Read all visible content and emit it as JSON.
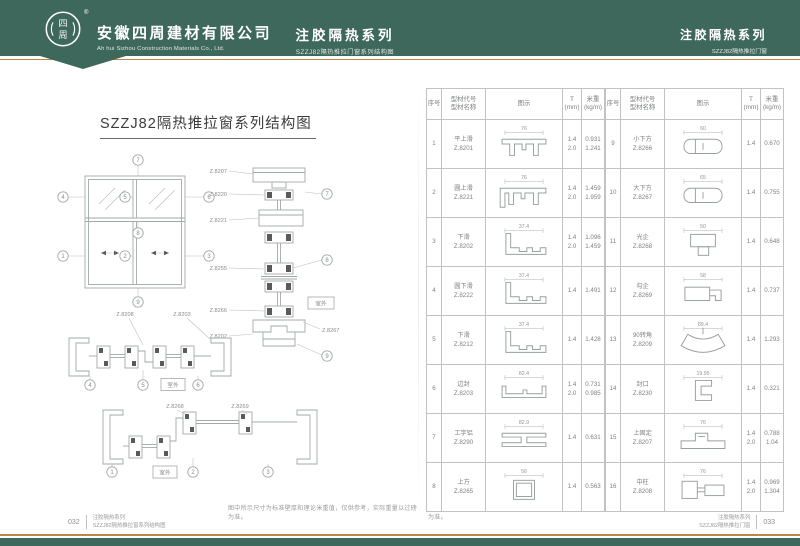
{
  "colors": {
    "header_green": "#3e685b",
    "accent_orange": "#c08448"
  },
  "header": {
    "logo_text": "四周",
    "registered_mark": "®",
    "company_name": "安徽四周建材有限公司",
    "company_name_en": "Ah hui Sizhou Construction Materials Co., Ltd.",
    "series_title": "注胶隔热系列",
    "series_subtitle": "SZZJ82隔热推拉门窗系列结构图",
    "series_title_right": "注胶隔热系列",
    "series_subtitle_right": "SZZJ82隔热推拉门窗"
  },
  "left_page": {
    "title": "SZZJ82隔热推拉窗系列结构图",
    "elevation_callouts": [
      "1",
      "2",
      "3",
      "4",
      "5",
      "6",
      "7",
      "8",
      "9"
    ],
    "vertical_labels": [
      "Z.8207",
      "Z.8220",
      "Z.8221",
      "Z.8255",
      "Z.8266",
      "Z.8202"
    ],
    "vertical_label_right": "Z.8267",
    "vertical_callouts": [
      "7",
      "8",
      "9"
    ],
    "h1_labels": [
      "Z.8208",
      "Z.8203"
    ],
    "h1_callouts": [
      "4",
      "5",
      "6"
    ],
    "h2_labels": [
      "Z.8268",
      "Z.8269"
    ],
    "h2_callouts": [
      "1",
      "2",
      "3"
    ],
    "outdoor_label": "室外",
    "note": "图中所示尺寸为标准壁厚和理论米重值，仅供参考，实际重量以过磅为准。"
  },
  "right_page": {
    "note": "图中所示尺寸为标准壁厚和理论米重值，仅供参考，实际重量以过磅为准。"
  },
  "tables": [
    {
      "headers": {
        "no": "序号",
        "name": "型材代号\n型材名称",
        "diagram": "图示",
        "t": "T\n(mm)",
        "weight": "米重\n(kg/m)"
      },
      "rows": [
        {
          "no": "1",
          "name": "平上滑",
          "code": "Z.8201",
          "t": "1.4\n2.0",
          "weight": "0.931\n1.241",
          "dim": "76",
          "shape": "tophat"
        },
        {
          "no": "2",
          "name": "圆上滑",
          "code": "Z.8221",
          "t": "1.4\n2.0",
          "weight": "1.459\n1.959",
          "dim": "76",
          "shape": "tophat2"
        },
        {
          "no": "3",
          "name": "下滑",
          "code": "Z.8202",
          "t": "1.4\n2.0",
          "weight": "1.096\n1.459",
          "dim": "37.4",
          "shape": "lrail"
        },
        {
          "no": "4",
          "name": "圆下滑",
          "code": "Z.8222",
          "t": "1.4",
          "weight": "1.491",
          "dim": "37.4",
          "shape": "lrail"
        },
        {
          "no": "5",
          "name": "下滑",
          "code": "Z.8212",
          "t": "1.4",
          "weight": "1.428",
          "dim": "37.4",
          "shape": "lrail"
        },
        {
          "no": "6",
          "name": "边封",
          "code": "Z.8203",
          "t": "1.4\n2.0",
          "weight": "0.731\n0.985",
          "dim": "82.4",
          "shape": "channel"
        },
        {
          "no": "7",
          "name": "工字铝",
          "code": "Z.8290",
          "t": "1.4",
          "weight": "0.631",
          "dim": "82.9",
          "shape": "ibeam"
        },
        {
          "no": "8",
          "name": "上方",
          "code": "Z.8265",
          "t": "1.4",
          "weight": "0.563",
          "dim": "56",
          "shape": "tube"
        }
      ]
    },
    {
      "headers": {
        "no": "序号",
        "name": "型材代号\n型材名称",
        "diagram": "图示",
        "t": "T\n(mm)",
        "weight": "米重\n(kg/m)"
      },
      "rows": [
        {
          "no": "9",
          "name": "小下方",
          "code": "Z.8266",
          "t": "1.4",
          "weight": "0.670",
          "dim": "60",
          "shape": "tubeR"
        },
        {
          "no": "10",
          "name": "大下方",
          "code": "Z.8267",
          "t": "1.4",
          "weight": "0.755",
          "dim": "65",
          "shape": "tubeR"
        },
        {
          "no": "11",
          "name": "光企",
          "code": "Z.8268",
          "t": "1.4",
          "weight": "0.648",
          "dim": "50",
          "shape": "lock"
        },
        {
          "no": "12",
          "name": "勾企",
          "code": "Z.8269",
          "t": "1.4",
          "weight": "0.737",
          "dim": "58",
          "shape": "hook"
        },
        {
          "no": "13",
          "name": "90转角",
          "code": "Z.8209",
          "t": "1.4",
          "weight": "1.293",
          "dim": "89.4",
          "shape": "fan"
        },
        {
          "no": "14",
          "name": "封口",
          "code": "Z.8230",
          "t": "1.4",
          "weight": "0.321",
          "dim": "19.95",
          "shape": "cap"
        },
        {
          "no": "15",
          "name": "上固定",
          "code": "Z.8207",
          "t": "1.4\n2.0",
          "weight": "0.788\n1.04",
          "dim": "76",
          "shape": "hat"
        },
        {
          "no": "16",
          "name": "中柱",
          "code": "Z.8208",
          "t": "1.4\n2.0",
          "weight": "0.969\n1.304",
          "dim": "76",
          "shape": "mid"
        }
      ]
    }
  ],
  "footer": {
    "left_page_no": "032",
    "left_line1": "注胶隔热系列",
    "left_line2": "SZZJ82隔热推拉窗系列结构图",
    "right_line1": "注胶隔热系列",
    "right_line2": "SZZJ82隔热推拉门窗",
    "right_page_no": "033"
  }
}
